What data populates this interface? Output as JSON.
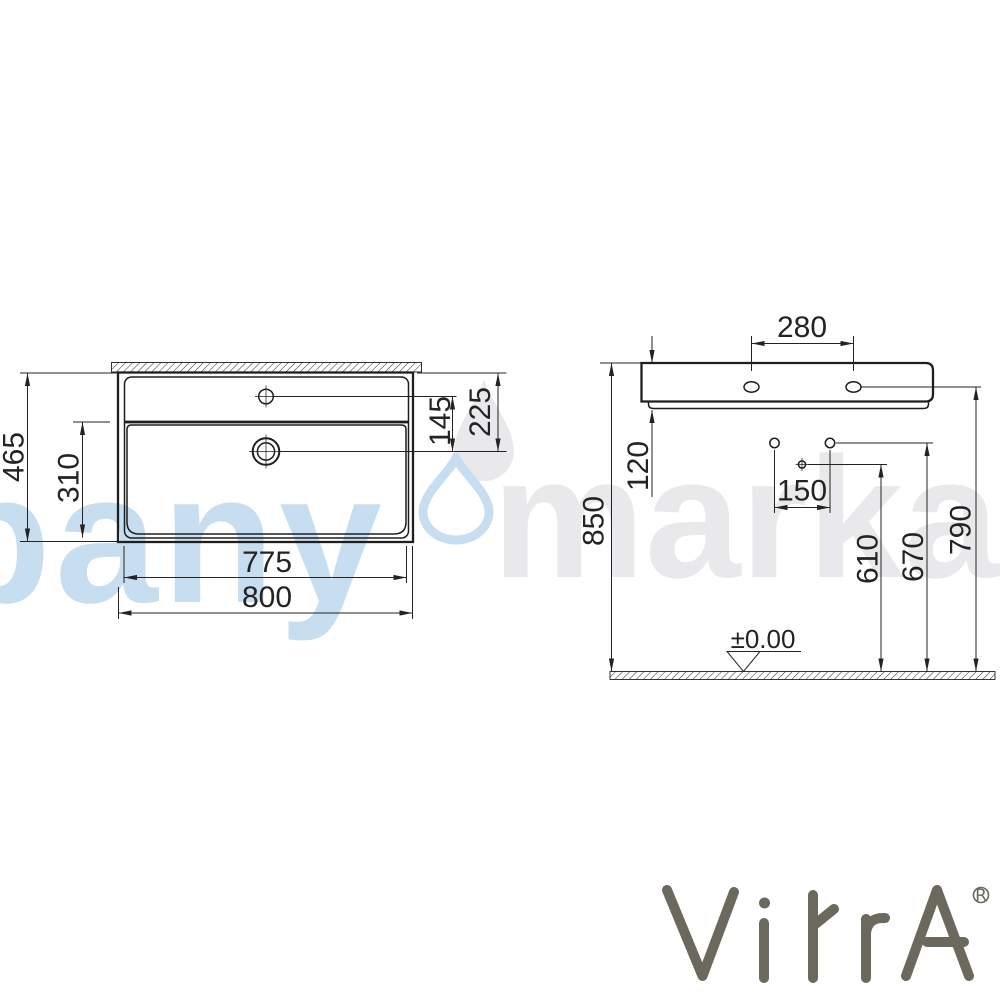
{
  "watermark": {
    "left_text": "bany",
    "right_text": "marka",
    "blue_color": "#c7def1",
    "gray_color": "#e9e9eb"
  },
  "logo": {
    "brand": "VitrA",
    "registered": "®",
    "color": "#6b685e"
  },
  "views": {
    "plan": {
      "name": "washbasin plan view",
      "dims": {
        "overall_depth": "465",
        "basin_depth": "310",
        "faucet_to_drain": "145",
        "back_to_drain": "225",
        "inner_width": "775",
        "overall_width": "800"
      }
    },
    "side": {
      "name": "washbasin side elevation",
      "dims": {
        "fixing_hole_spacing": "280",
        "body_height": "120",
        "bracket_hole_spacing": "150",
        "drain_height": "610",
        "bracket_height": "670",
        "fixing_hole_height": "790",
        "rim_height": "850",
        "floor_level": "±0.00"
      }
    }
  }
}
